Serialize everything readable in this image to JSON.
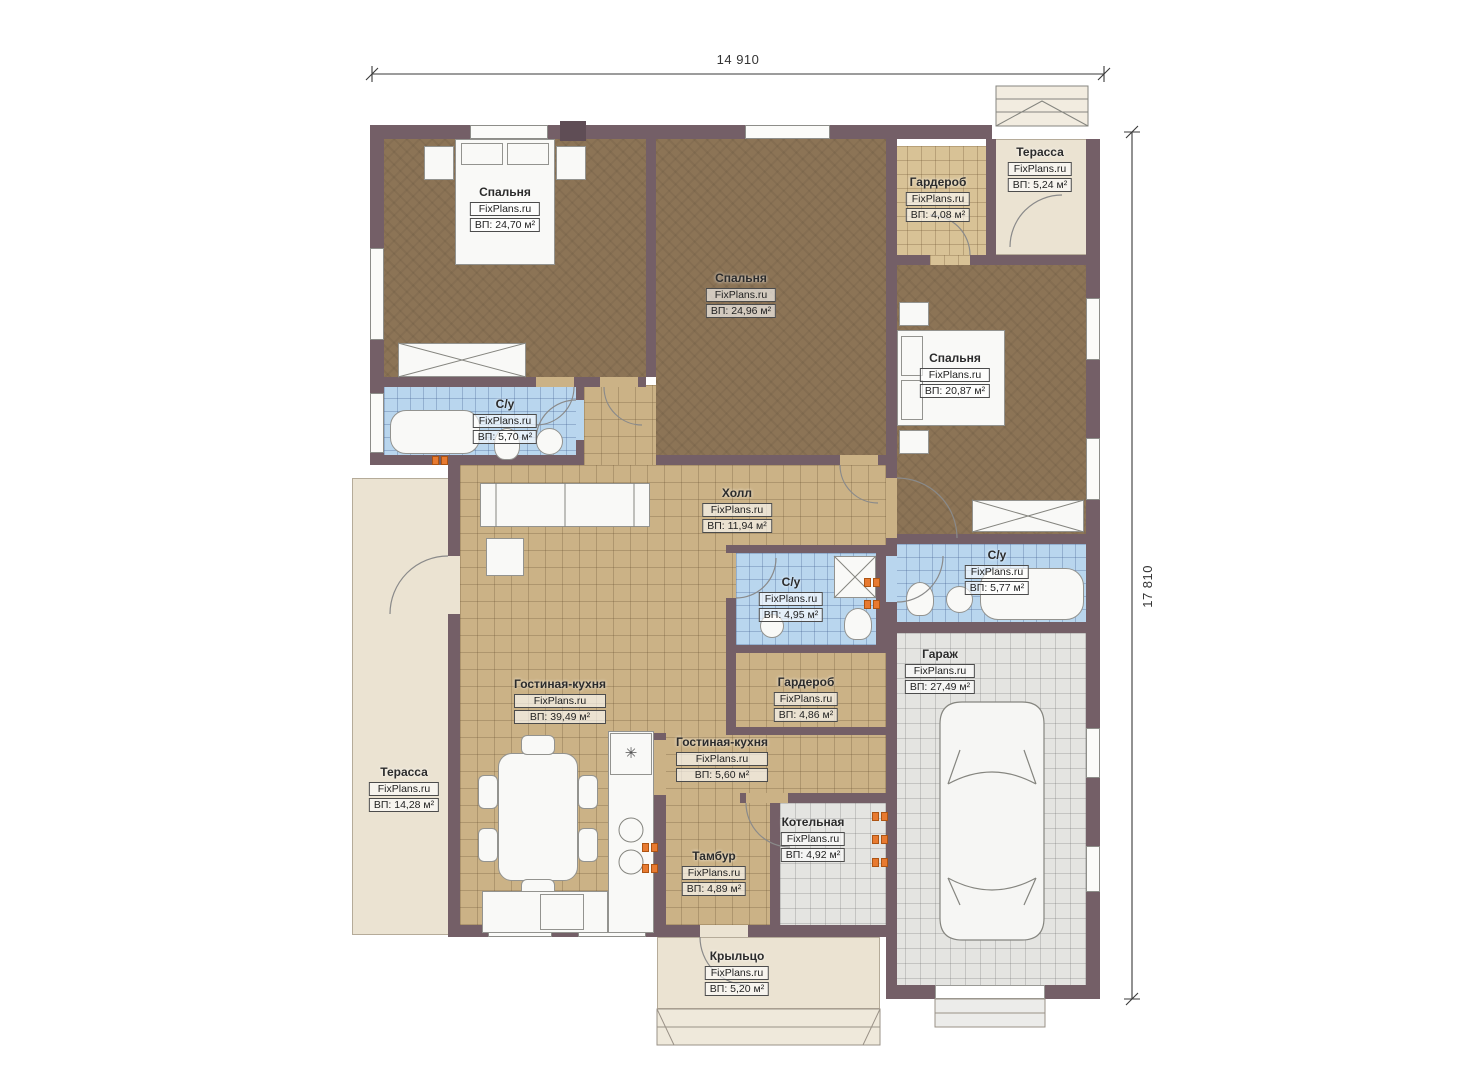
{
  "dimensions": {
    "top": "14 910",
    "right": "17 810"
  },
  "watermark": "FixPlans.ru",
  "rooms": [
    {
      "id": "bedroom-1",
      "name": "Спальня",
      "area": "ВП: 24,70 м²"
    },
    {
      "id": "bedroom-2",
      "name": "Спальня",
      "area": "ВП: 24,96 м²"
    },
    {
      "id": "wardrobe-top",
      "name": "Гардероб",
      "area": "ВП: 4,08 м²"
    },
    {
      "id": "terrace-top",
      "name": "Терасса",
      "area": "ВП: 5,24 м²"
    },
    {
      "id": "bedroom-3",
      "name": "Спальня",
      "area": "ВП: 20,87 м²"
    },
    {
      "id": "bathroom-left",
      "name": "С/у",
      "area": "ВП: 5,70 м²"
    },
    {
      "id": "hall",
      "name": "Холл",
      "area": "ВП: 11,94 м²"
    },
    {
      "id": "bathroom-center",
      "name": "С/у",
      "area": "ВП: 4,95 м²"
    },
    {
      "id": "bathroom-right",
      "name": "С/у",
      "area": "ВП: 5,77 м²"
    },
    {
      "id": "garage",
      "name": "Гараж",
      "area": "ВП: 27,49 м²"
    },
    {
      "id": "living-kitchen",
      "name": "Гостиная-кухня",
      "area": "ВП: 39,49 м²"
    },
    {
      "id": "wardrobe-center",
      "name": "Гардероб",
      "area": "ВП: 4,86 м²"
    },
    {
      "id": "living-kitchen-2",
      "name": "Гостиная-кухня",
      "area": "ВП: 5,60 м²"
    },
    {
      "id": "boiler-room",
      "name": "Котельная",
      "area": "ВП: 4,92 м²"
    },
    {
      "id": "vestibule",
      "name": "Тамбур",
      "area": "ВП: 4,89 м²"
    },
    {
      "id": "terrace-left",
      "name": "Терасса",
      "area": "ВП: 14,28 м²"
    },
    {
      "id": "porch",
      "name": "Крыльцо",
      "area": "ВП: 5,20 м²"
    }
  ],
  "colors": {
    "wall": "#745f67",
    "bedroom_floor": "#8c7456",
    "tile_floor": "#cbb286",
    "bath_floor": "#b9d6ee",
    "terrace_floor": "#ebe3d2",
    "garage_floor": "#e4e4e1",
    "wardrobe_floor": "#d8c296",
    "outlet": "#e87a30"
  }
}
